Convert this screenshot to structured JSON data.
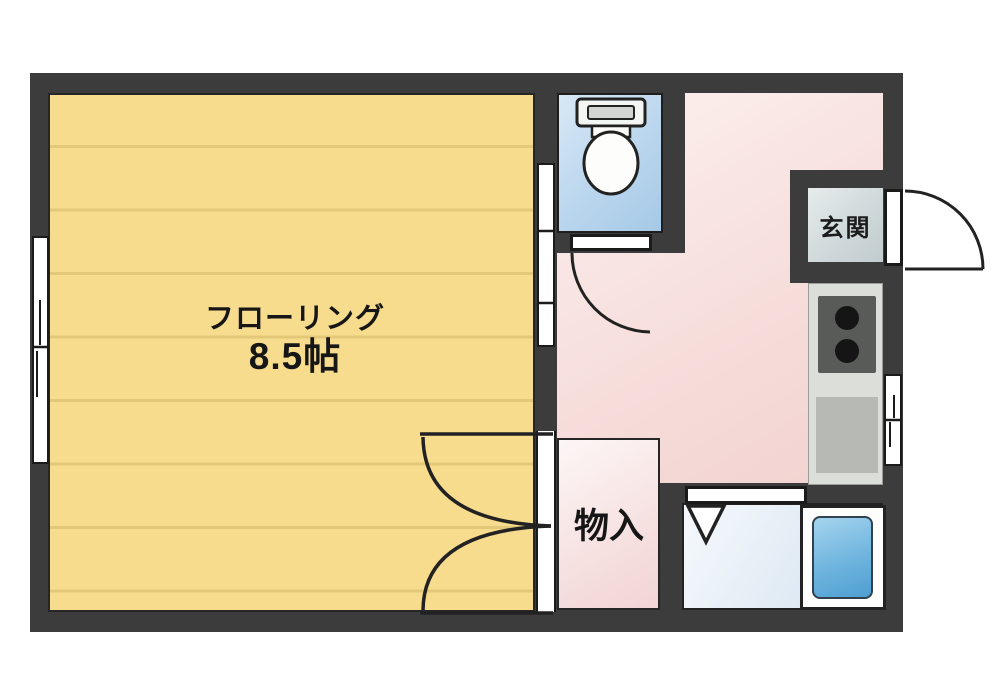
{
  "plan": {
    "type": "apartment-floor-plan",
    "rooms": {
      "main": {
        "name_label": "フローリング",
        "size_label": "8.5帖"
      },
      "closet": {
        "label": "物入"
      },
      "entrance": {
        "label": "玄関"
      },
      "toilet": {
        "fixture": "toilet-icon"
      },
      "bathroom": {
        "fixture": "bathtub-icon"
      },
      "kitchen": {
        "fixtures": [
          "stove-burners-icon",
          "sink-basin"
        ]
      }
    },
    "openings": {
      "left_window": "sliding-window",
      "right_window": "sliding-window",
      "main_room_slide_door": "sliding-door",
      "closet_double_door": "double-swing-door",
      "toilet_door": "swing-door",
      "bath_door": "folding-door",
      "entry_door": "outward-swing-door"
    },
    "colors": {
      "wall": "#3b3c3b",
      "main_floor": "#f8dc8e",
      "main_floor_stripe": "#e3c87a",
      "hallway_floor": "#f6dedb",
      "toilet_floor": "#bcd7ee",
      "closet_floor": "#f5dddd",
      "bathroom_floor": "#e2ecf5",
      "bathtub": "#6fb5de",
      "entrance_tile": "#cdd7d9",
      "counter": "#dcdeda",
      "stove": "#595b59",
      "line": "#222222"
    }
  }
}
